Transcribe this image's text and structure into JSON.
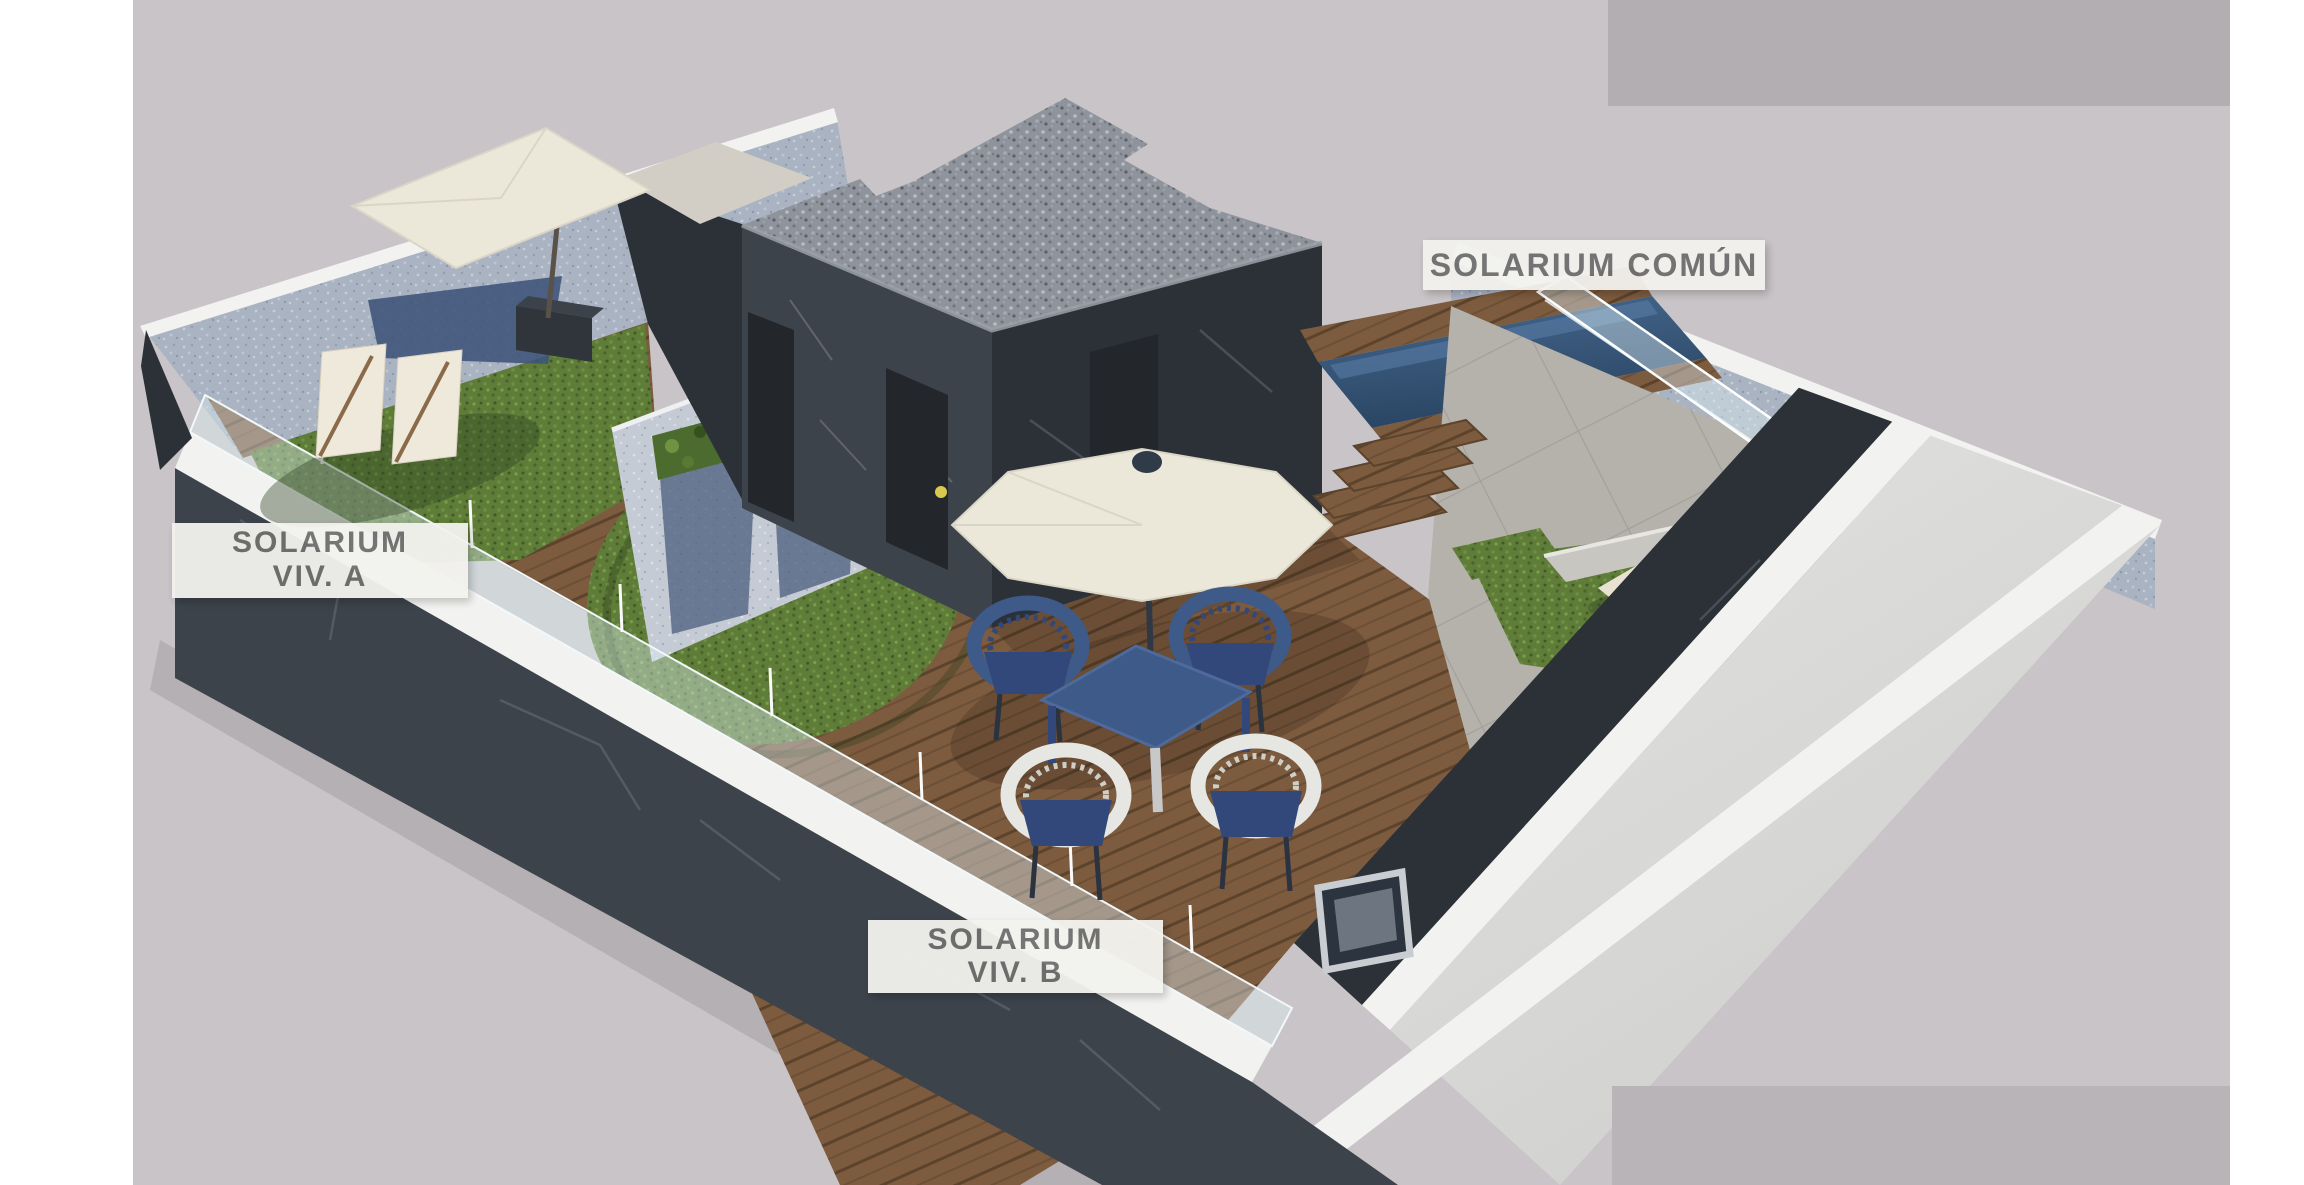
{
  "labels": {
    "common": {
      "text": "SOLARIUM COMÚN"
    },
    "viv_a": {
      "line1": "SOLARIUM",
      "line2": "VIV. A"
    },
    "viv_b": {
      "line1": "SOLARIUM",
      "line2": "VIV. B"
    }
  },
  "scene": {
    "type": "3d-architectural-render",
    "areas": [
      {
        "id": "solarium-viv-a",
        "label": "SOLARIUM VIV. A"
      },
      {
        "id": "solarium-viv-b",
        "label": "SOLARIUM VIV. B"
      },
      {
        "id": "solarium-comun",
        "label": "SOLARIUM COMÚN"
      }
    ]
  },
  "palette": {
    "bg_canvas": "#c9c4c7",
    "block_top": "#b3aeb2",
    "block_bottom": "#b9b4b8",
    "label_bg": "#f3f2ee",
    "label_text": "#6f6f6f",
    "coping": "#f2f2f0",
    "wall_dark": "#3d434b",
    "wall_darker": "#2c3137",
    "door": "#23272c",
    "glass": "#ddeef4",
    "parasol": "#ebe7d9",
    "navy": "#3e5a88",
    "navy_dark": "#32487a",
    "chair_white": "#e6e6e2",
    "lounger": "#e9e2d2",
    "sail_shadow": "#3c5377",
    "handle": "#d8ca4e",
    "frame_metal": "#c9cdd1",
    "wood": "#7d5b3e",
    "grass": "#5f7d38",
    "gravel": "#8f939c",
    "stone": "#b5b2ac",
    "pool_top": "#46688f",
    "pool_bottom": "#2a4563"
  }
}
